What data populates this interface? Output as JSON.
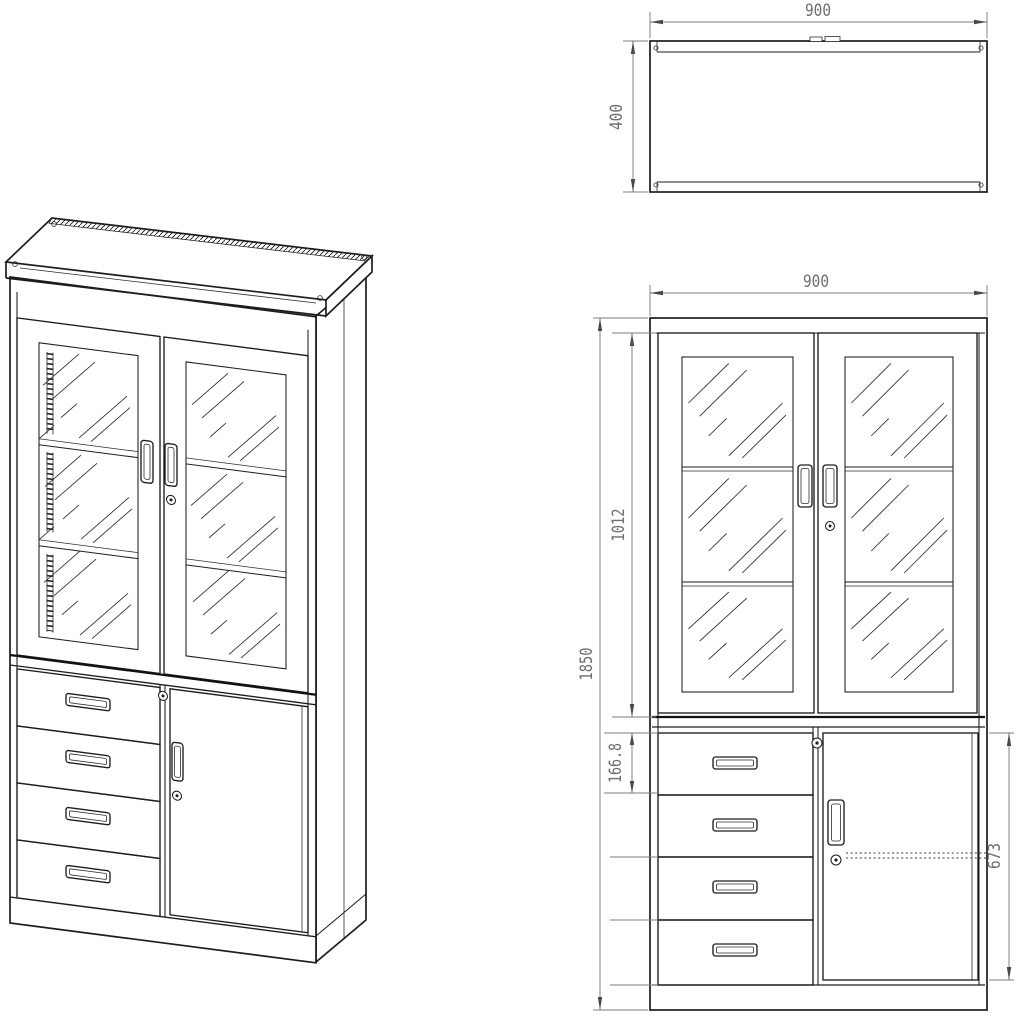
{
  "drawing": {
    "type": "cabinet-technical-drawing",
    "colors": {
      "line": "#1d1d1d",
      "dimension": "#7d7d7d",
      "text": "#6e6e6e",
      "background": "#ffffff"
    },
    "views": {
      "isometric": {
        "label": "isometric-projection"
      },
      "top": {
        "dim_width": "900",
        "dim_depth": "400"
      },
      "front": {
        "dim_width": "900",
        "dim_total_height": "1850",
        "dim_glass_section_height": "1012",
        "dim_drawer_height": "166.8",
        "dim_lower_door_height": "673"
      }
    }
  }
}
